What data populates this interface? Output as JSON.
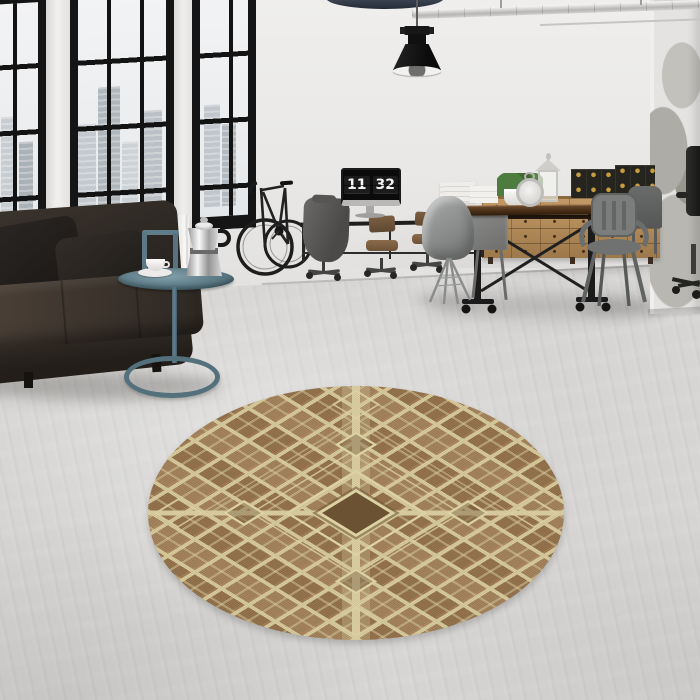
{
  "scene": {
    "description": "Industrial loft interior photo: black-framed factory windows with a city view, dark leather sofa, teal side table with a moka pot and coffee cup, bicycle against the wall, desk with a monitor showing a flip clock, wooden trestle dining table with metal chairs, oak apothecary sideboard with black storage chests, black pendant lamp, and a round brown-and-cream geometric rug centered on a concrete floor",
    "clock": {
      "hours": "11",
      "minutes": "32"
    }
  },
  "colors": {
    "wall": "#e9e8e6",
    "floor": "#d6d5d3",
    "window_frame": "#151515",
    "rug_base": "#9a7850",
    "rug_cream": "#ddd2a4",
    "rug_dark": "#6b5232",
    "rug_accent": "#c89c72",
    "sofa_leather": "#332c26",
    "side_table": "#5b7884",
    "wood_furniture": "#b28a58",
    "dining_table_top": "#4a3018",
    "metal_chair": "#787b7a",
    "lamp_black": "#161616",
    "brass_hardware": "#c59d3f",
    "plant_green": "#4e7c3e"
  }
}
